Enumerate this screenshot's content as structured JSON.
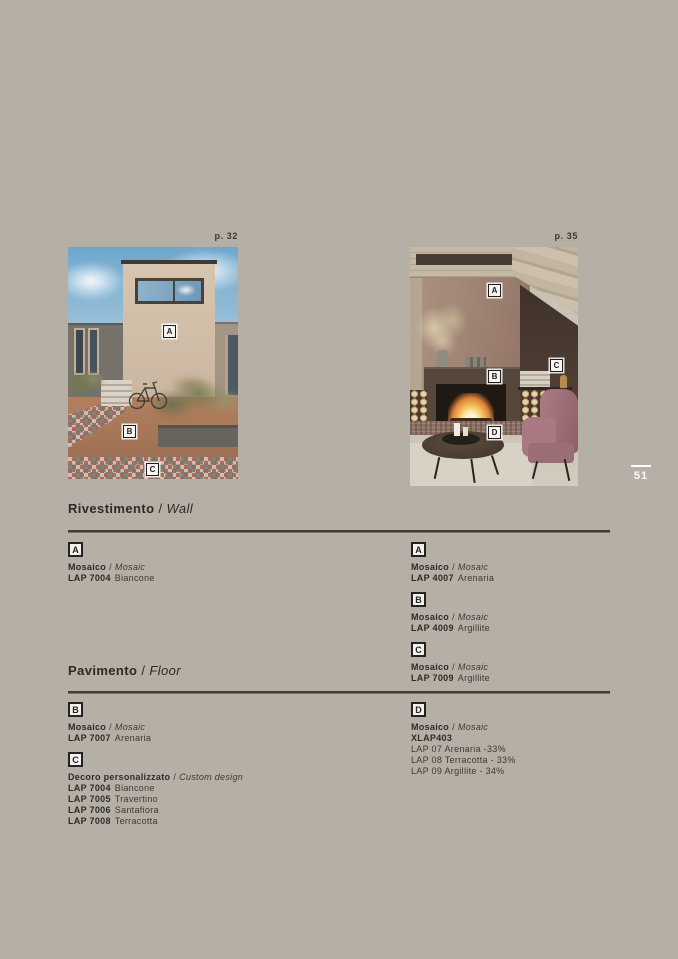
{
  "page": {
    "number": "51",
    "bg_color": "#b5afa6",
    "accent_dark": "#3f3b35"
  },
  "photos": {
    "left": {
      "page_ref": "p. 32",
      "markers": [
        "A",
        "B",
        "C"
      ]
    },
    "right": {
      "page_ref": "p. 35",
      "markers": [
        "A",
        "B",
        "C",
        "D"
      ]
    }
  },
  "sections": {
    "wall": {
      "title_it": "Rivestimento",
      "sep": "/",
      "title_en": "Wall",
      "left": [
        {
          "marker": "A",
          "type_it": "Mosaico",
          "sep": "/",
          "type_en": "Mosaic",
          "lines": [
            {
              "code": "LAP 7004",
              "name": "Biancone"
            }
          ]
        }
      ],
      "right": [
        {
          "marker": "A",
          "type_it": "Mosaico",
          "sep": "/",
          "type_en": "Mosaic",
          "lines": [
            {
              "code": "LAP 4007",
              "name": "Arenaria"
            }
          ]
        },
        {
          "marker": "B",
          "type_it": "Mosaico",
          "sep": "/",
          "type_en": "Mosaic",
          "lines": [
            {
              "code": "LAP 4009",
              "name": "Argillite"
            }
          ]
        },
        {
          "marker": "C",
          "type_it": "Mosaico",
          "sep": "/",
          "type_en": "Mosaic",
          "lines": [
            {
              "code": "LAP 7009",
              "name": "Argillite"
            }
          ]
        }
      ]
    },
    "floor": {
      "title_it": "Pavimento",
      "sep": "/",
      "title_en": "Floor",
      "left": [
        {
          "marker": "B",
          "type_it": "Mosaico",
          "sep": "/",
          "type_en": "Mosaic",
          "lines": [
            {
              "code": "LAP 7007",
              "name": "Arenaria"
            }
          ]
        },
        {
          "marker": "C",
          "type_it": "Decoro personalizzato",
          "sep": "/",
          "type_en": "Custom design",
          "lines": [
            {
              "code": "LAP 7004",
              "name": "Biancone"
            },
            {
              "code": "LAP 7005",
              "name": "Travertino"
            },
            {
              "code": "LAP 7006",
              "name": "Santafiora"
            },
            {
              "code": "LAP 7008",
              "name": "Terracotta"
            }
          ]
        }
      ],
      "right": [
        {
          "marker": "D",
          "type_it": "Mosaico",
          "sep": "/",
          "type_en": "Mosaic",
          "lines": [
            {
              "code": "XLAP403",
              "name": ""
            },
            {
              "code": "",
              "name": "LAP 07 Arenaria -33%"
            },
            {
              "code": "",
              "name": "LAP 08 Terracotta - 33%"
            },
            {
              "code": "",
              "name": "LAP 09 Argillite - 34%"
            }
          ]
        }
      ]
    }
  }
}
